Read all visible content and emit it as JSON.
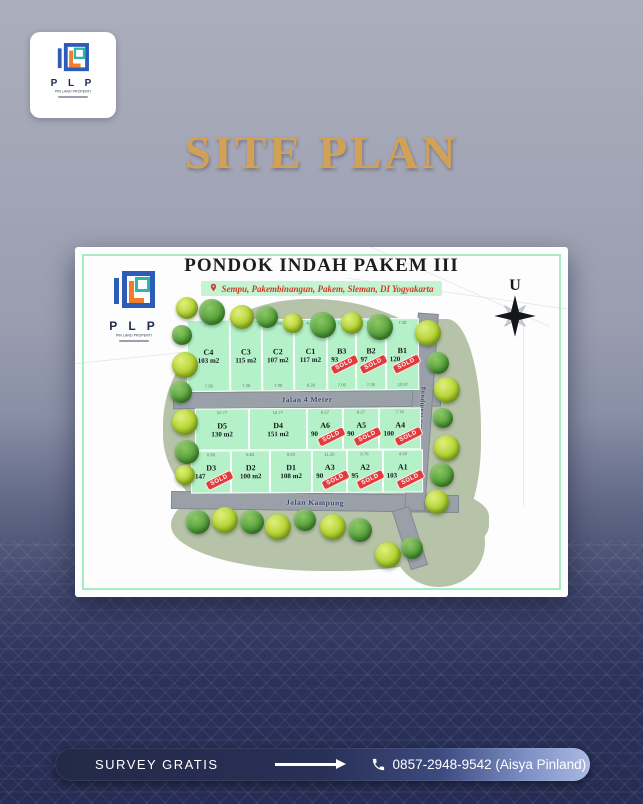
{
  "poster": {
    "title": "SITE PLAN",
    "colors": {
      "title_gold": "#d2a156",
      "background_top": "#abaebc",
      "background_bottom": "#262c52",
      "footer_navy": "#283056",
      "plot_mint": "#b4f1c9",
      "road_gray": "#9aa0a8",
      "sold_red": "#e23b3b",
      "logo_blue": "#2d5bb8",
      "logo_teal": "#2ab9a9",
      "logo_orange": "#ef7d2a"
    }
  },
  "brand": {
    "initials": "P L P",
    "tagline": "PIN LAND PROPERTI"
  },
  "map": {
    "title": "PONDOK INDAH PAKEM III",
    "location": "Sempu, Pakembinangun, Pakem, Sleman, DI Yogyakarta",
    "compass_label": "U",
    "sold_label": "SOLD",
    "roads": {
      "middle": "Jalan 4 Meter",
      "bottom": "Jalan Kampung",
      "right": "Jalan Kampung"
    },
    "rows": [
      {
        "plots": [
          {
            "id": "C4",
            "area": "103 m2",
            "dim": "7.03",
            "dim2": "7.38",
            "sold": false
          },
          {
            "id": "C3",
            "area": "115 m2",
            "dim": "7.06",
            "dim2": "7.36",
            "sold": false
          },
          {
            "id": "C2",
            "area": "107 m2",
            "dim": "7.08",
            "dim2": "7.08",
            "sold": false
          },
          {
            "id": "C1",
            "area": "117 m2",
            "dim": "4.63",
            "dim2": "6.32",
            "sold": false
          },
          {
            "id": "B3",
            "area": "93",
            "dim": "7.32",
            "dim2": "7.00",
            "sold": true
          },
          {
            "id": "B2",
            "area": "97",
            "dim": "7.31",
            "dim2": "7.38",
            "sold": true
          },
          {
            "id": "B1",
            "area": "120",
            "dim": "7.28",
            "dim2": "10.87",
            "sold": true
          }
        ]
      },
      {
        "plots": [
          {
            "id": "D5",
            "area": "130 m2",
            "dim": "10.77",
            "sold": false
          },
          {
            "id": "D4",
            "area": "151 m2",
            "dim": "12.77",
            "sold": false
          },
          {
            "id": "A6",
            "area": "90",
            "dim": "8.27",
            "sold": true
          },
          {
            "id": "A5",
            "area": "90",
            "dim": "8.27",
            "sold": true
          },
          {
            "id": "A4",
            "area": "100",
            "dim": "7.78",
            "sold": true
          }
        ]
      },
      {
        "plots": [
          {
            "id": "D3",
            "area": "147",
            "dim": "6.85",
            "sold": true
          },
          {
            "id": "D2",
            "area": "100 m2",
            "dim": "5.82",
            "sold": false
          },
          {
            "id": "D1",
            "area": "108 m2",
            "dim": "9.83",
            "sold": false
          },
          {
            "id": "A3",
            "area": "90",
            "dim": "11.28",
            "sold": true
          },
          {
            "id": "A2",
            "area": "95",
            "dim": "8.76",
            "sold": true
          },
          {
            "id": "A1",
            "area": "103",
            "dim": "4.53",
            "sold": true
          }
        ]
      }
    ]
  },
  "footer": {
    "cta": "SURVEY GRATIS",
    "phone": "0857-2948-9542 (Aisya Pinland)"
  }
}
